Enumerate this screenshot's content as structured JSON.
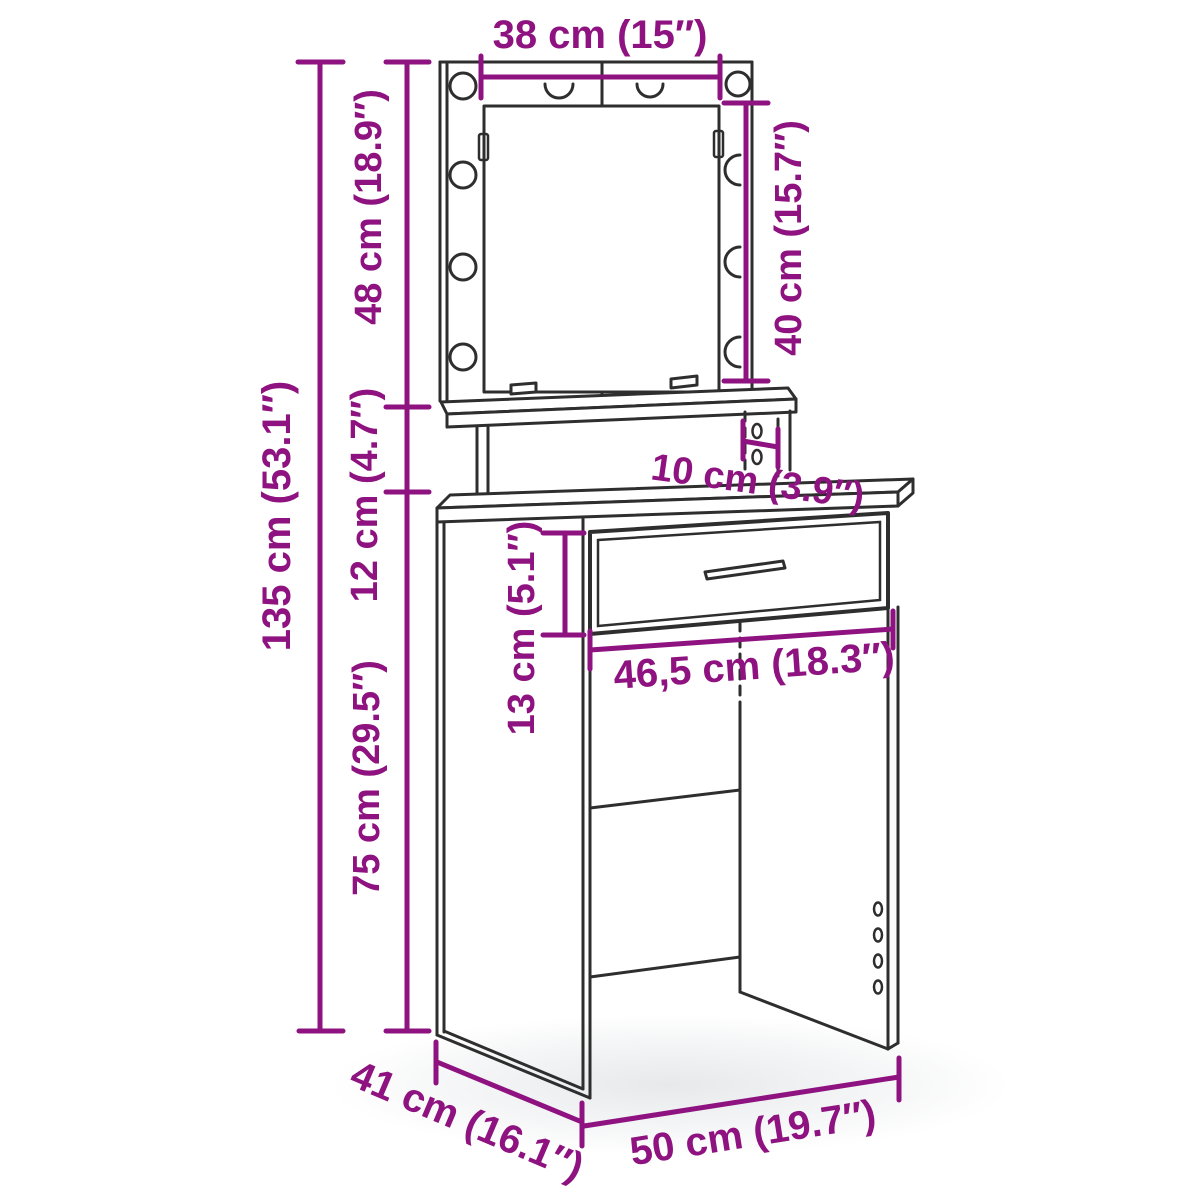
{
  "title": "Dressing table with LED mirror — dimension diagram",
  "colors": {
    "dimension_accent": "#8E127F",
    "line_art": "#2E2E2E",
    "background": "#FFFFFF"
  },
  "dimensions": {
    "mirror_width": "38 cm (15″)",
    "mirror_panel_height": "48 cm (18.9″)",
    "mirror_height": "40 cm (15.7″)",
    "total_height": "135 cm (53.1″)",
    "shelf_section_height": "12 cm (4.7″)",
    "shelf_depth": "10 cm (3.9″)",
    "drawer_front_height": "13 cm (5.1″)",
    "drawer_width": "46,5 cm (18.3″)",
    "table_section_height": "75 cm (29.5″)",
    "table_depth": "41 cm (16.1″)",
    "table_width": "50 cm (19.7″)"
  }
}
